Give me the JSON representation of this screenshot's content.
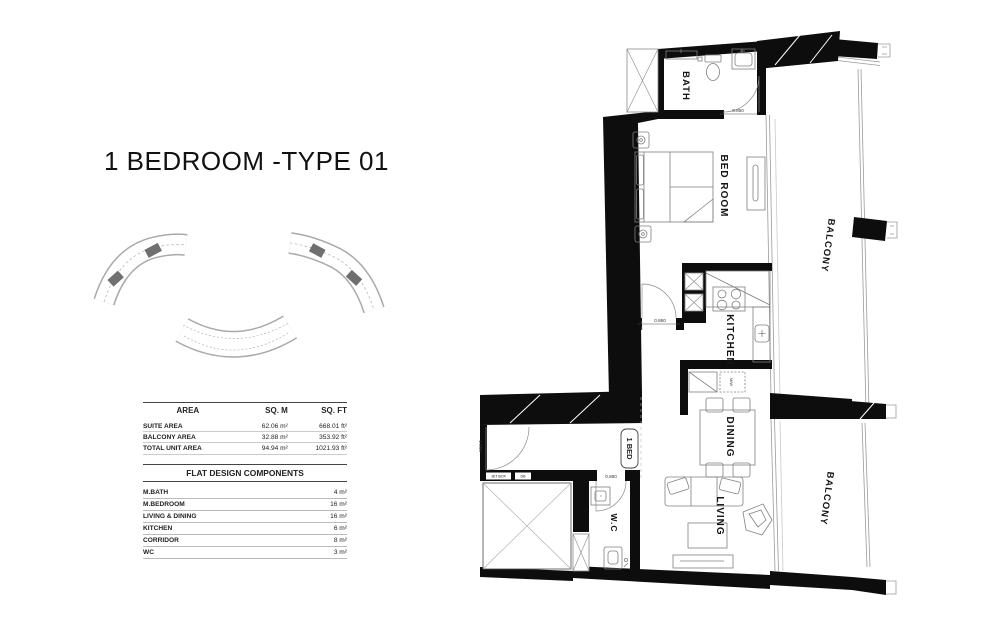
{
  "page": {
    "title": "1 BEDROOM -TYPE 01"
  },
  "area_table": {
    "headers": {
      "area": "AREA",
      "sqm": "SQ. M",
      "sqft": "SQ. FT"
    },
    "rows": [
      {
        "name": "SUITE AREA",
        "sqm": "62.06 m²",
        "sqft": "668.01 ft²"
      },
      {
        "name": "BALCONY AREA",
        "sqm": "32.88 m²",
        "sqft": "353.92 ft²"
      },
      {
        "name": "TOTAL UNIT AREA",
        "sqm": "94.94 m²",
        "sqft": "1021.93 ft²"
      }
    ]
  },
  "components_table": {
    "title": "FLAT DESIGN COMPONENTS",
    "rows": [
      {
        "name": "M.BATH",
        "value": "4 m²"
      },
      {
        "name": "M.BEDROOM",
        "value": "16 m²"
      },
      {
        "name": "LIVING & DINING",
        "value": "16 m²"
      },
      {
        "name": "KITCHEN",
        "value": "6 m²"
      },
      {
        "name": "CORRIDOR",
        "value": "8 m²"
      },
      {
        "name": "WC",
        "value": "3 m²"
      }
    ]
  },
  "floor_plan": {
    "rooms": {
      "bath": "BATH",
      "bedroom": "BED ROOM",
      "kitchen": "KITCHEN",
      "dining": "DINING",
      "living": "LIVING",
      "wc": "W.C",
      "balcony_upper": "BALCONY",
      "balcony_lower": "BALCONY",
      "unit_badge": "1 BED"
    },
    "annotations": {
      "bath_door": "0.860",
      "bedroom_door": "0.860",
      "wc_door": "0.860",
      "entry_width": "1.050",
      "microwave": "M/W",
      "jet_box": "JET BOX",
      "db": "DB"
    }
  },
  "colors": {
    "wall": "#0d0d0d",
    "furniture_line": "#888888",
    "highlight_unit": "#6f6f6f"
  }
}
